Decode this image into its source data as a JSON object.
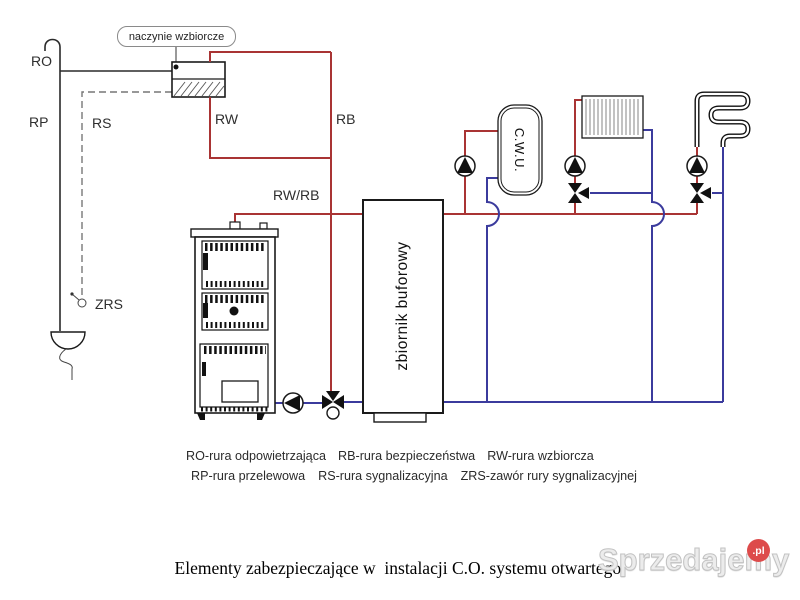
{
  "labels": {
    "ro": "RO",
    "rp": "RP",
    "rs": "RS",
    "rw": "RW",
    "rb": "RB",
    "rwrb": "RW/RB",
    "zrs": "ZRS",
    "expansion_vessel": "naczynie wzbiorcze",
    "buffer_tank": "zbiornik buforowy",
    "cwu_tank": "C.W.U."
  },
  "legend": {
    "row1": [
      "RO-rura odpowietrzająca",
      "RB-rura bezpieczeństwa",
      "RW-rura wzbiorcza"
    ],
    "row2": [
      "RP-rura przelewowa",
      "RS-rura sygnalizacyjna",
      "ZRS-zawór rury sygnalizacyjnej"
    ]
  },
  "caption": "Elementy zabezpieczające w  instalacji C.O. systemu otwartego.",
  "watermark": {
    "name": "Sprzedajemy",
    "tld": ".pl"
  },
  "colors": {
    "supply_pipe": "#a93434",
    "return_pipe": "#3b3b9d",
    "outline": "#1a1a1a",
    "watermark_badge": "#dd4b4b"
  }
}
